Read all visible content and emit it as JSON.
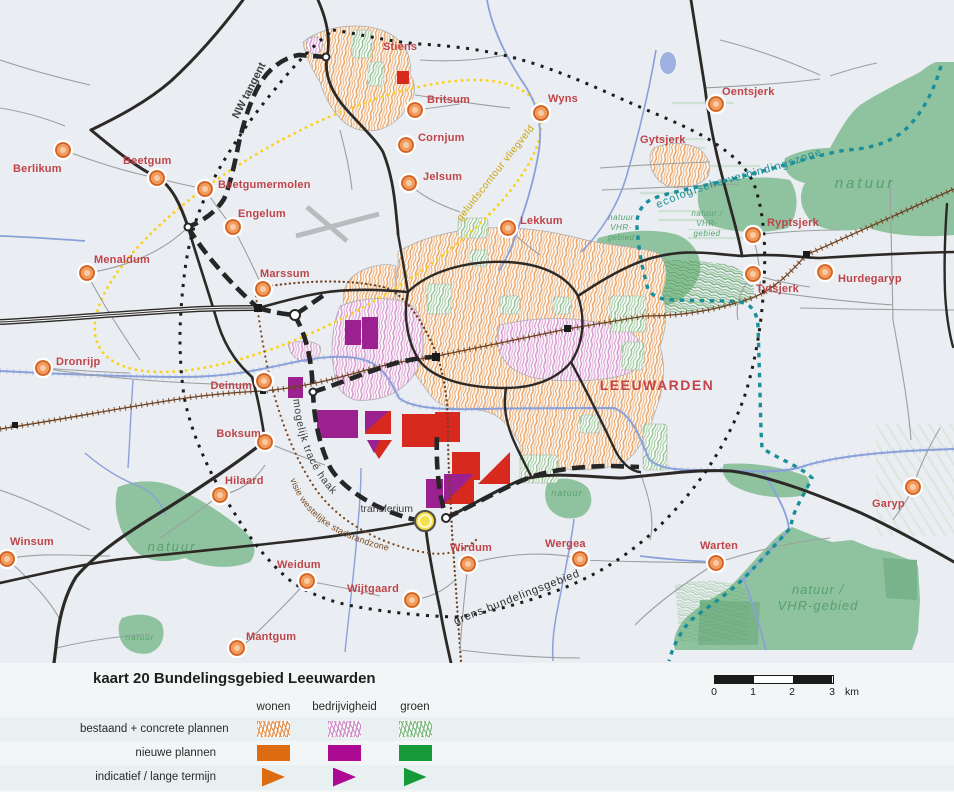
{
  "map": {
    "city_label": "LEEUWARDEN",
    "towns": [
      {
        "name": "Stiens",
        "lx": 383,
        "ly": 50,
        "anchor": "start"
      },
      {
        "name": "Britsum",
        "mx": 415,
        "my": 110,
        "lx": 427,
        "ly": 103,
        "anchor": "start"
      },
      {
        "name": "Cornjum",
        "mx": 406,
        "my": 145,
        "lx": 418,
        "ly": 141,
        "anchor": "start"
      },
      {
        "name": "Jelsum",
        "mx": 409,
        "my": 183,
        "lx": 423,
        "ly": 180,
        "anchor": "start"
      },
      {
        "name": "Wyns",
        "mx": 541,
        "my": 113,
        "lx": 548,
        "ly": 102,
        "anchor": "start"
      },
      {
        "name": "Lekkum",
        "mx": 508,
        "my": 228,
        "lx": 520,
        "ly": 224,
        "anchor": "start"
      },
      {
        "name": "Oentsjerk",
        "mx": 716,
        "my": 104,
        "lx": 722,
        "ly": 95,
        "anchor": "start"
      },
      {
        "name": "Gytsjerk",
        "lx": 640,
        "ly": 143,
        "anchor": "start"
      },
      {
        "name": "Ryptsjerk",
        "mx": 753,
        "my": 235,
        "lx": 767,
        "ly": 226,
        "anchor": "start"
      },
      {
        "name": "Tytsjerk",
        "mx": 753,
        "my": 274,
        "lx": 756,
        "ly": 292,
        "anchor": "start"
      },
      {
        "name": "Hurdegaryp",
        "mx": 825,
        "my": 272,
        "lx": 838,
        "ly": 282,
        "anchor": "start"
      },
      {
        "name": "Berlikum",
        "mx": 63,
        "my": 150,
        "lx": 13,
        "ly": 172,
        "anchor": "start"
      },
      {
        "name": "Beetgum",
        "mx": 157,
        "my": 178,
        "lx": 123,
        "ly": 164,
        "anchor": "start"
      },
      {
        "name": "Beetgumermolen",
        "mx": 205,
        "my": 189,
        "lx": 218,
        "ly": 188,
        "anchor": "start"
      },
      {
        "name": "Engelum",
        "mx": 233,
        "my": 227,
        "lx": 238,
        "ly": 217,
        "anchor": "start"
      },
      {
        "name": "Menaldum",
        "mx": 87,
        "my": 273,
        "lx": 94,
        "ly": 263,
        "anchor": "start"
      },
      {
        "name": "Marssum",
        "mx": 263,
        "my": 289,
        "lx": 260,
        "ly": 277,
        "anchor": "start"
      },
      {
        "name": "Dronrijp",
        "mx": 43,
        "my": 368,
        "lx": 56,
        "ly": 365,
        "anchor": "start"
      },
      {
        "name": "Deinum",
        "mx": 264,
        "my": 381,
        "lx": 252,
        "ly": 389,
        "anchor": "end"
      },
      {
        "name": "Boksum",
        "mx": 265,
        "my": 442,
        "lx": 261,
        "ly": 437,
        "anchor": "end"
      },
      {
        "name": "Hilaard",
        "mx": 220,
        "my": 495,
        "lx": 225,
        "ly": 484,
        "anchor": "start"
      },
      {
        "name": "Winsum",
        "mx": 7,
        "my": 559,
        "lx": 10,
        "ly": 545,
        "anchor": "start"
      },
      {
        "name": "Weidum",
        "mx": 307,
        "my": 581,
        "lx": 277,
        "ly": 568,
        "anchor": "start"
      },
      {
        "name": "Mantgum",
        "mx": 237,
        "my": 648,
        "lx": 246,
        "ly": 640,
        "anchor": "start"
      },
      {
        "name": "Wijtgaard",
        "mx": 412,
        "my": 600,
        "lx": 399,
        "ly": 592,
        "anchor": "end"
      },
      {
        "name": "Wirdum",
        "mx": 468,
        "my": 564,
        "lx": 450,
        "ly": 551,
        "anchor": "start"
      },
      {
        "name": "Wergea",
        "mx": 580,
        "my": 559,
        "lx": 545,
        "ly": 547,
        "anchor": "start"
      },
      {
        "name": "Warten",
        "mx": 716,
        "my": 563,
        "lx": 700,
        "ly": 549,
        "anchor": "start"
      },
      {
        "name": "Garyp",
        "mx": 913,
        "my": 487,
        "lx": 872,
        "ly": 507,
        "anchor": "start"
      }
    ],
    "nature_labels": [
      {
        "lines": [
          "natuur"
        ],
        "x": 172,
        "y": 551,
        "size": 13,
        "ls": 2,
        "lh": 14
      },
      {
        "lines": [
          "natuur"
        ],
        "x": 140,
        "y": 640,
        "size": 8,
        "ls": 1,
        "lh": 9
      },
      {
        "lines": [
          "natuur"
        ],
        "x": 567,
        "y": 496,
        "size": 9,
        "ls": 1,
        "lh": 10
      },
      {
        "lines": [
          "natuur"
        ],
        "x": 865,
        "y": 188,
        "size": 15,
        "ls": 3,
        "lh": 16
      },
      {
        "lines": [
          "natuur /",
          "VHR-gebied"
        ],
        "x": 818,
        "y": 594,
        "size": 13,
        "ls": 1,
        "lh": 16
      },
      {
        "lines": [
          "natuur",
          "VHR-",
          "gebied"
        ],
        "x": 621,
        "y": 220,
        "size": 8,
        "ls": 0.5,
        "lh": 10
      },
      {
        "lines": [
          "natuur /",
          "VHR-",
          "gebied"
        ],
        "x": 707,
        "y": 216,
        "size": 8,
        "ls": 0.5,
        "lh": 10
      }
    ],
    "curve_labels": [
      {
        "text": "geluidscontour vliegveld",
        "path": "lp-geluid",
        "size": 10,
        "color": "#c9a40c",
        "ls": 0.5
      },
      {
        "text": "ecologische verbindingszone",
        "path": "lp-ecol",
        "size": 11,
        "color": "#1d8e96",
        "ls": 1.2
      },
      {
        "text": "mogelijk tracé haak",
        "path": "lp-haak",
        "size": 10.5,
        "color": "#3e3e3e",
        "ls": 0.8
      },
      {
        "text": "visie westelijke stadsrandzone",
        "path": "lp-stadsrand",
        "size": 9,
        "color": "#7a4a22",
        "ls": 0.2
      },
      {
        "text": "grens bundelingsgebied",
        "path": "lp-grens",
        "size": 11,
        "color": "#2e2e2e",
        "ls": 0.8
      }
    ],
    "rot_labels": [
      {
        "text": "NW tangent",
        "x": 252,
        "y": 92,
        "rot": -63,
        "size": 11,
        "color": "#3e3e3e",
        "weight": "bold",
        "anchor": "middle"
      },
      {
        "text": "transferium",
        "x": 413,
        "y": 512,
        "rot": 0,
        "size": 10.5,
        "color": "#3e3e3e",
        "weight": "normal",
        "anchor": "end"
      }
    ]
  },
  "legend": {
    "title": "kaart 20 Bundelingsgebied Leeuwarden",
    "columns": [
      "wonen",
      "bedrijvigheid",
      "groen"
    ],
    "rows": [
      "bestaand + concrete plannen",
      "nieuwe plannen",
      "indicatief / lange termijn"
    ],
    "colors": {
      "wonen_hatch": "#e2914f",
      "bedrijvigheid_hatch": "#cf8bc8",
      "groen_hatch": "#7cb97e",
      "wonen_solid": "#dd6b10",
      "bedrijvigheid_solid": "#ad0a94",
      "groen_solid": "#169a38"
    }
  },
  "scalebar": {
    "ticks": [
      "0",
      "1",
      "2",
      "3"
    ],
    "unit": "km"
  }
}
